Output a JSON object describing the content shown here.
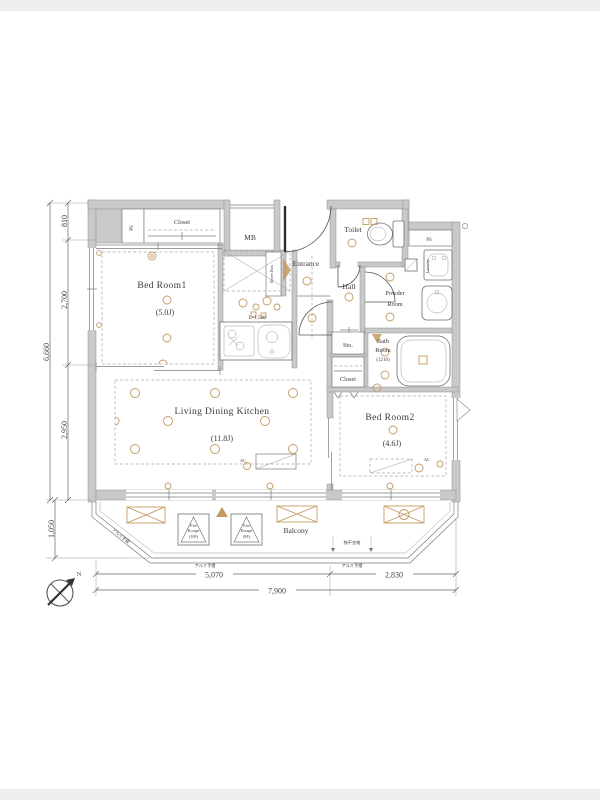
{
  "plan": {
    "rooms": {
      "bedroom1": {
        "name": "Bed Room1",
        "size": "(5.0J)"
      },
      "ldk": {
        "name": "Living Dining Kitchen",
        "size": "(11.8J)"
      },
      "bedroom2": {
        "name": "Bed Room2",
        "size": "(4.6J)"
      },
      "bath": {
        "l1": "Bath",
        "l2": "Room",
        "l3": "(1216)"
      },
      "powder": {
        "l1": "Powder",
        "l2": "Room"
      },
      "toilet": "Toilet",
      "hall": "Hall",
      "entrance": "Entrance",
      "balcony": "Balcony",
      "closet_top": "Closet",
      "closet_hall": "Closet",
      "sto": "Sto.",
      "mb": "MB",
      "ps_left": "PS",
      "ps_right": "PS",
      "shoes_box": "Shoes Box",
      "laundry": "Laundry"
    },
    "labels": {
      "kitchen_length": "L=1,500",
      "fire_escape_1": {
        "l1": "Fire",
        "l2": "Escape",
        "l3": "(10F)"
      },
      "fire_escape_2": {
        "l1": "Fire",
        "l2": "Escape",
        "l3": "(9F)"
      },
      "handrail_left": "アルミ手摺",
      "handrail_bottom1": "アルミ手摺",
      "handrail_bottom2": "アルミ手摺",
      "laundry_pole": "物干金物",
      "ac1": "AC",
      "ac2": "AC",
      "compass_n": "N"
    },
    "dimensions": {
      "left": [
        "810",
        "2,700",
        "2,950"
      ],
      "left_total": "6,660",
      "balcony_depth": "1,050",
      "bottom": [
        "5,070",
        "2,830"
      ],
      "bottom_total": "7,900"
    },
    "colors": {
      "wall": "#c9c9c9",
      "accent_tan": "#c49a63",
      "line": "#555555",
      "text": "#3a3a3a"
    }
  }
}
